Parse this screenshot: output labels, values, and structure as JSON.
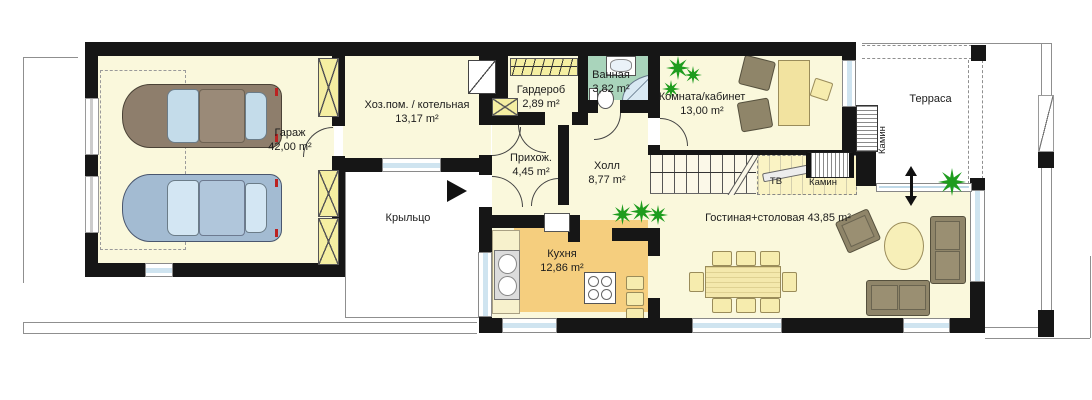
{
  "plan": {
    "title": "Floor plan — ground floor",
    "rooms": {
      "garage": {
        "name": "Гараж",
        "area": "42,00 m²"
      },
      "utility": {
        "name": "Хоз.пом. / котельная",
        "area": "13,17 m²"
      },
      "wardrobe": {
        "name": "Гардероб",
        "area": "2,89 m²"
      },
      "bathroom": {
        "name": "Ванная",
        "area": "3,82 m²"
      },
      "office": {
        "name": "Комната/кабинет",
        "area": "13,00 m²"
      },
      "entry_hall": {
        "name": "Прихож.",
        "area": "4,45 m²"
      },
      "hall": {
        "name": "Холл",
        "area": "8,77 m²"
      },
      "porch": {
        "name": "Крыльцо"
      },
      "kitchen": {
        "name": "Кухня",
        "area": "12,86 m²"
      },
      "living_dining": {
        "name": "Гостиная+столовая",
        "area": "43,85 m²"
      },
      "terrace": {
        "name": "Терраса"
      }
    },
    "labels": {
      "tv": "ТВ",
      "fireplace": "Камин",
      "chimney": "Камин"
    },
    "colors": {
      "wall": "#161616",
      "floor_cream": "#FAF8DC",
      "kitchen_orange": "#F5CE7E",
      "bathroom_green": "#A9D4BB",
      "shaft_yellow": "#F5EFA2",
      "glass_blue": "#CFE4F0",
      "furniture_brown": "#8F8569",
      "wood_pale": "#F4E8AC",
      "plant_green": "#1E9C1E",
      "car_brown": "#8E7E6C",
      "car_blue": "#A3BBD2"
    }
  }
}
